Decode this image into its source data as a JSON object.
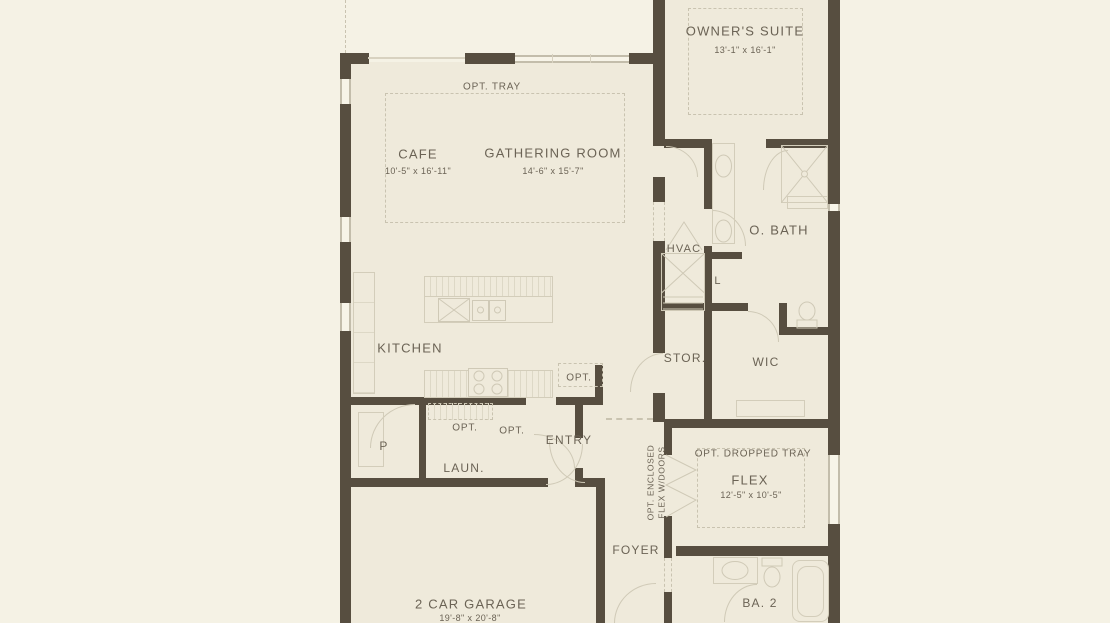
{
  "colors": {
    "wall": "#574e40",
    "page_background": "#f5f2e5",
    "interior_background": "#efeadb",
    "fixture_line": "#d3cdba",
    "dashed_line": "#c9c3b0",
    "text": "#6b6355"
  },
  "plan": {
    "lanai": {
      "dims": "25'-4\" x 10'-0\""
    },
    "owners_suite": {
      "name": "OWNER'S SUITE",
      "dims": "13'-1\" x 16'-1\""
    },
    "great_room": {
      "opt_tray_label": "OPT. TRAY"
    },
    "cafe": {
      "name": "CAFE",
      "dims": "10'-5\" x 16'-11\""
    },
    "gathering_room": {
      "name": "GATHERING ROOM",
      "dims": "14'-6\" x 15'-7\""
    },
    "kitchen": {
      "name": "KITCHEN",
      "opt_label": "OPT."
    },
    "hvac": {
      "name": "HVAC"
    },
    "owners_bath": {
      "name": "O. BATH",
      "linen_label": "L"
    },
    "storage": {
      "name": "STOR."
    },
    "wic": {
      "name": "WIC"
    },
    "pantry": {
      "name": "P"
    },
    "laundry": {
      "name": "LAUN.",
      "opt_label_1": "OPT.",
      "opt_label_2": "OPT."
    },
    "entry": {
      "name": "ENTRY"
    },
    "foyer": {
      "name": "FOYER"
    },
    "flex": {
      "name": "FLEX",
      "dims": "12'-5\" x 10'-5\"",
      "opt_tray_label": "OPT. DROPPED TRAY",
      "opt_doors_label_line1": "OPT. ENCLOSED",
      "opt_doors_label_line2": "FLEX W/DOORS"
    },
    "garage": {
      "name": "2 CAR GARAGE",
      "dims": "19'-8\" x 20'-8\""
    },
    "bath2": {
      "name": "BA. 2"
    }
  }
}
